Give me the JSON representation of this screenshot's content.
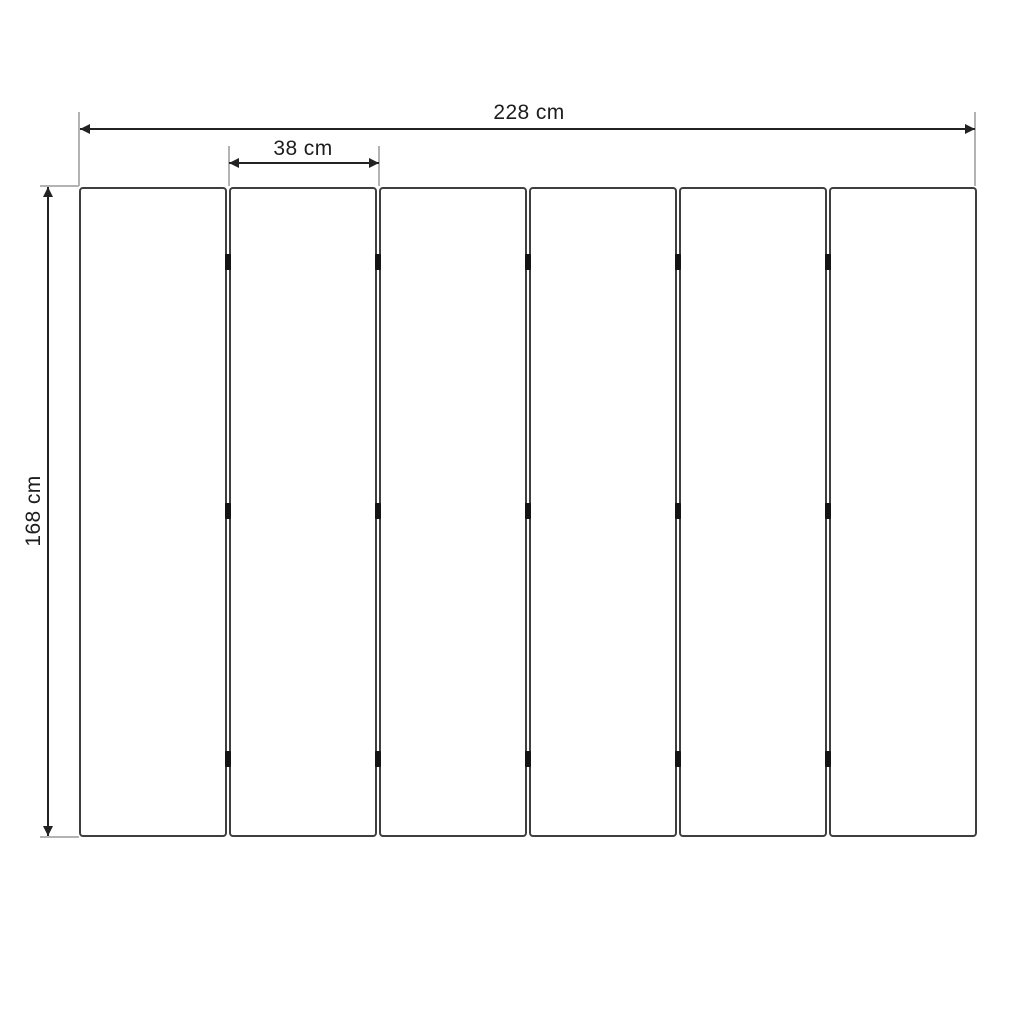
{
  "diagram": {
    "type": "panel-dimension-drawing",
    "labels": {
      "total_width": "228 cm",
      "panel_width": "38 cm",
      "height": "168 cm"
    },
    "dimensions": {
      "total_width_cm": 228,
      "panel_width_cm": 38,
      "height_cm": 168,
      "unit": "cm"
    },
    "panels": {
      "count": 6,
      "gaps": 5,
      "hinges_per_gap": 3
    },
    "colors": {
      "background": "#ffffff",
      "dimension_line": "#222222",
      "extension_line": "#b3b3b3",
      "panel_border": "#3f3f3f",
      "hinge": "#141414",
      "text": "#1d1d1d"
    },
    "geometry": {
      "panels_left": 79,
      "panel_top": 187,
      "panel_width_px": 148,
      "panel_height_px": 650,
      "panel_pitch_px": 150,
      "hinge_y_px": [
        262,
        511,
        759
      ]
    }
  }
}
